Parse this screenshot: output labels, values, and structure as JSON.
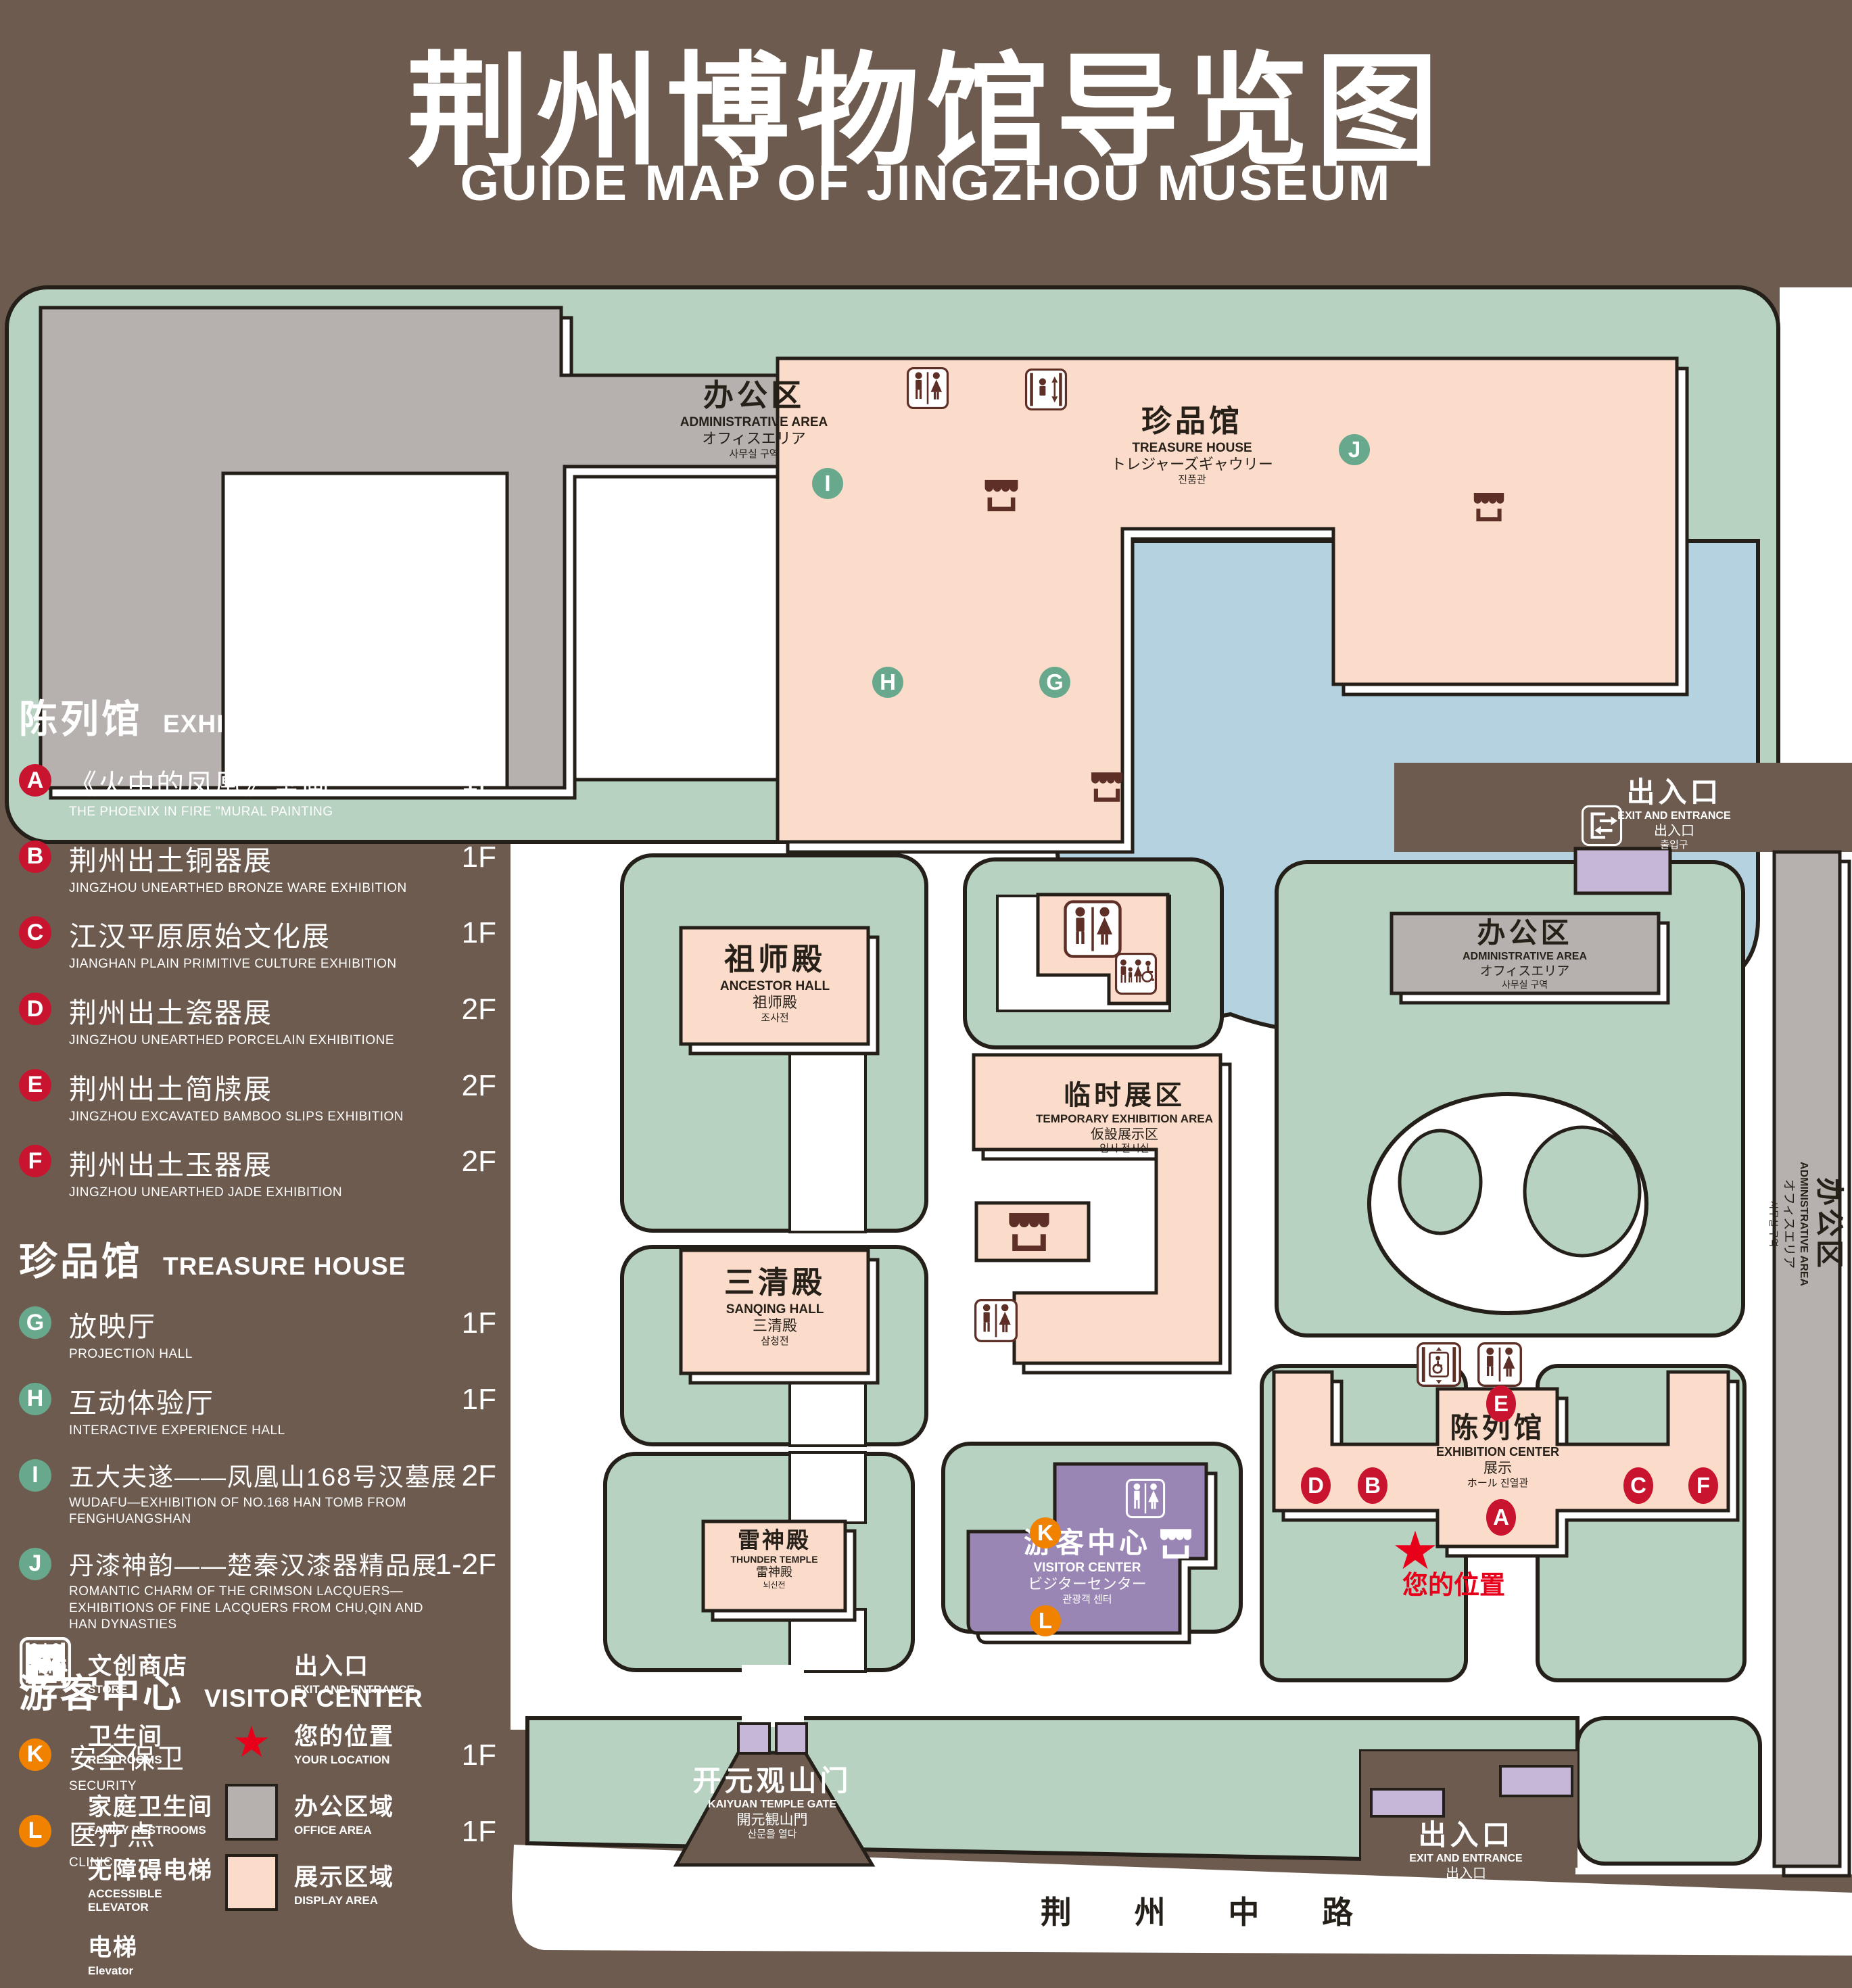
{
  "title": {
    "zh": "荆州博物馆导览图",
    "en": "GUIDE MAP OF JINGZHOU MUSEUM"
  },
  "legend": {
    "sections": [
      {
        "zh": "陈列馆",
        "en": "EXHIBITION CENTER",
        "items": [
          {
            "letter": "A",
            "zh": "《火中的凤凰》壁画",
            "en": "THE PHOENIX IN FIRE \"MURAL PAINTING",
            "floor": "1F"
          },
          {
            "letter": "B",
            "zh": "荆州出土铜器展",
            "en": "JINGZHOU UNEARTHED BRONZE WARE EXHIBITION",
            "floor": "1F"
          },
          {
            "letter": "C",
            "zh": "江汉平原原始文化展",
            "en": "JIANGHAN PLAIN PRIMITIVE CULTURE EXHIBITION",
            "floor": "1F"
          },
          {
            "letter": "D",
            "zh": "荆州出土瓷器展",
            "en": "JINGZHOU UNEARTHED PORCELAIN EXHIBITIONE",
            "floor": "2F"
          },
          {
            "letter": "E",
            "zh": "荆州出土简牍展",
            "en": "JINGZHOU EXCAVATED BAMBOO SLIPS EXHIBITION",
            "floor": "2F"
          },
          {
            "letter": "F",
            "zh": "荆州出土玉器展",
            "en": "JINGZHOU UNEARTHED JADE EXHIBITION",
            "floor": "2F"
          }
        ]
      },
      {
        "zh": "珍品馆",
        "en": "TREASURE HOUSE",
        "items": [
          {
            "letter": "G",
            "zh": "放映厅",
            "en": "PROJECTION HALL",
            "floor": "1F"
          },
          {
            "letter": "H",
            "zh": "互动体验厅",
            "en": "INTERACTIVE EXPERIENCE HALL",
            "floor": "1F"
          },
          {
            "letter": "I",
            "zh": "五大夫遂——凤凰山168号汉墓展",
            "en": "WUDAFU—EXHIBITION OF NO.168 HAN TOMB FROM FENGHUANGSHAN",
            "floor": "2F"
          },
          {
            "letter": "J",
            "zh": "丹漆神韵——楚秦汉漆器精品展",
            "en": "ROMANTIC CHARM OF THE CRIMSON LACQUERS—EXHIBITIONS OF FINE LACQUERS FROM CHU,QIN AND HAN DYNASTIES",
            "floor": "1-2F"
          }
        ]
      },
      {
        "zh": "游客中心",
        "en": "VISITOR CENTER",
        "items": [
          {
            "letter": "K",
            "zh": "安全保卫",
            "en": "SECURITY",
            "floor": "1F"
          },
          {
            "letter": "L",
            "zh": "医疗点",
            "en": "CLINIC",
            "floor": "1F"
          }
        ]
      }
    ],
    "symbols": {
      "store": {
        "zh": "文创商店",
        "en": "STORE"
      },
      "restrooms": {
        "zh": "卫生间",
        "en": "RESTROOMS"
      },
      "family": {
        "zh": "家庭卫生间",
        "en": "FAMILY RESTROOMS"
      },
      "accessible": {
        "zh": "无障碍电梯",
        "en": "ACCESSIBLE ELEVATOR"
      },
      "elevator": {
        "zh": "电梯",
        "en": "Elevator"
      },
      "exit": {
        "zh": "出入口",
        "en": "EXIT AND ENTRANCE"
      },
      "location": {
        "zh": "您的位置",
        "en": "YOUR LOCATION"
      },
      "office": {
        "zh": "办公区域",
        "en": "OFFICE AREA"
      },
      "display": {
        "zh": "展示区域",
        "en": "DISPLAY AREA"
      }
    }
  },
  "map": {
    "buildings": {
      "admin_top": {
        "zh": "办公区",
        "en": "ADMINISTRATIVE AREA",
        "ja": "オフィスエリア",
        "ko": "사무실 구역"
      },
      "admin_mid": {
        "zh": "办公区",
        "en": "ADMINISTRATIVE AREA",
        "ja": "オフィスエリア",
        "ko": "사무실 구역"
      },
      "admin_side": {
        "zh": "办公区",
        "en": "ADMINISTRATIVE AREA",
        "ja": "オフィスエリア",
        "ko": "사무실 구역"
      },
      "treasure": {
        "zh": "珍品馆",
        "en": "TREASURE HOUSE",
        "ja": "トレジャーズギャウリー",
        "ko": "진품관"
      },
      "ancestor": {
        "zh": "祖师殿",
        "en": "ANCESTOR HALL",
        "ja": "祖师殿",
        "ko": "조사전"
      },
      "sanqing": {
        "zh": "三清殿",
        "en": "SANQING HALL",
        "ja": "三清殿",
        "ko": "삼청전"
      },
      "thunder": {
        "zh": "雷神殿",
        "en": "THUNDER TEMPLE",
        "ja": "雷神殿",
        "ko": "뇌신전"
      },
      "temporary": {
        "zh": "临时展区",
        "en": "TEMPORARY EXHIBITION AREA",
        "ja": "仮設展示区",
        "ko": "임시 전시실"
      },
      "visitor": {
        "zh": "游客中心",
        "en": "VISITOR CENTER",
        "ja": "ビジターセンター",
        "ko": "관광객 센터"
      },
      "exhibition": {
        "zh": "陈列馆",
        "en": "EXHIBITION CENTER",
        "ja": "展示",
        "ko": "ホール 진열관"
      },
      "gate": {
        "zh": "开元观山门",
        "en": "KAIYUAN TEMPLE GATE",
        "ja": "開元観山門",
        "ko": "산문을 열다"
      },
      "exit_top": {
        "zh": "出入口",
        "en": "EXIT AND ENTRANCE",
        "ja": "出入口",
        "ko": "출입구"
      },
      "exit_bottom": {
        "zh": "出入口",
        "en": "EXIT AND ENTRANCE",
        "ja": "出入口",
        "ko": "출입구"
      },
      "road": {
        "zh": "荆 州 中 路"
      },
      "your_location": {
        "zh": "您的位置"
      }
    },
    "markers": {
      "a": "A",
      "b": "B",
      "c": "C",
      "d": "D",
      "e": "E",
      "f": "F",
      "g": "G",
      "h": "H",
      "i": "I",
      "j": "J",
      "k": "K",
      "l": "L"
    },
    "colors": {
      "green": "#b7d2c1",
      "pink": "#fbdccb",
      "gray": "#b6b1ae",
      "blue": "#b4d2e0",
      "purple": "#9a86b4",
      "lavender": "#c6b6d8",
      "brown_bg": "#6d5b4f",
      "icon_brown": "#5d2f26",
      "badge_red": "#c9142f",
      "badge_green": "#68a88c",
      "badge_orange": "#f08200",
      "star_red": "#e8001b"
    }
  }
}
